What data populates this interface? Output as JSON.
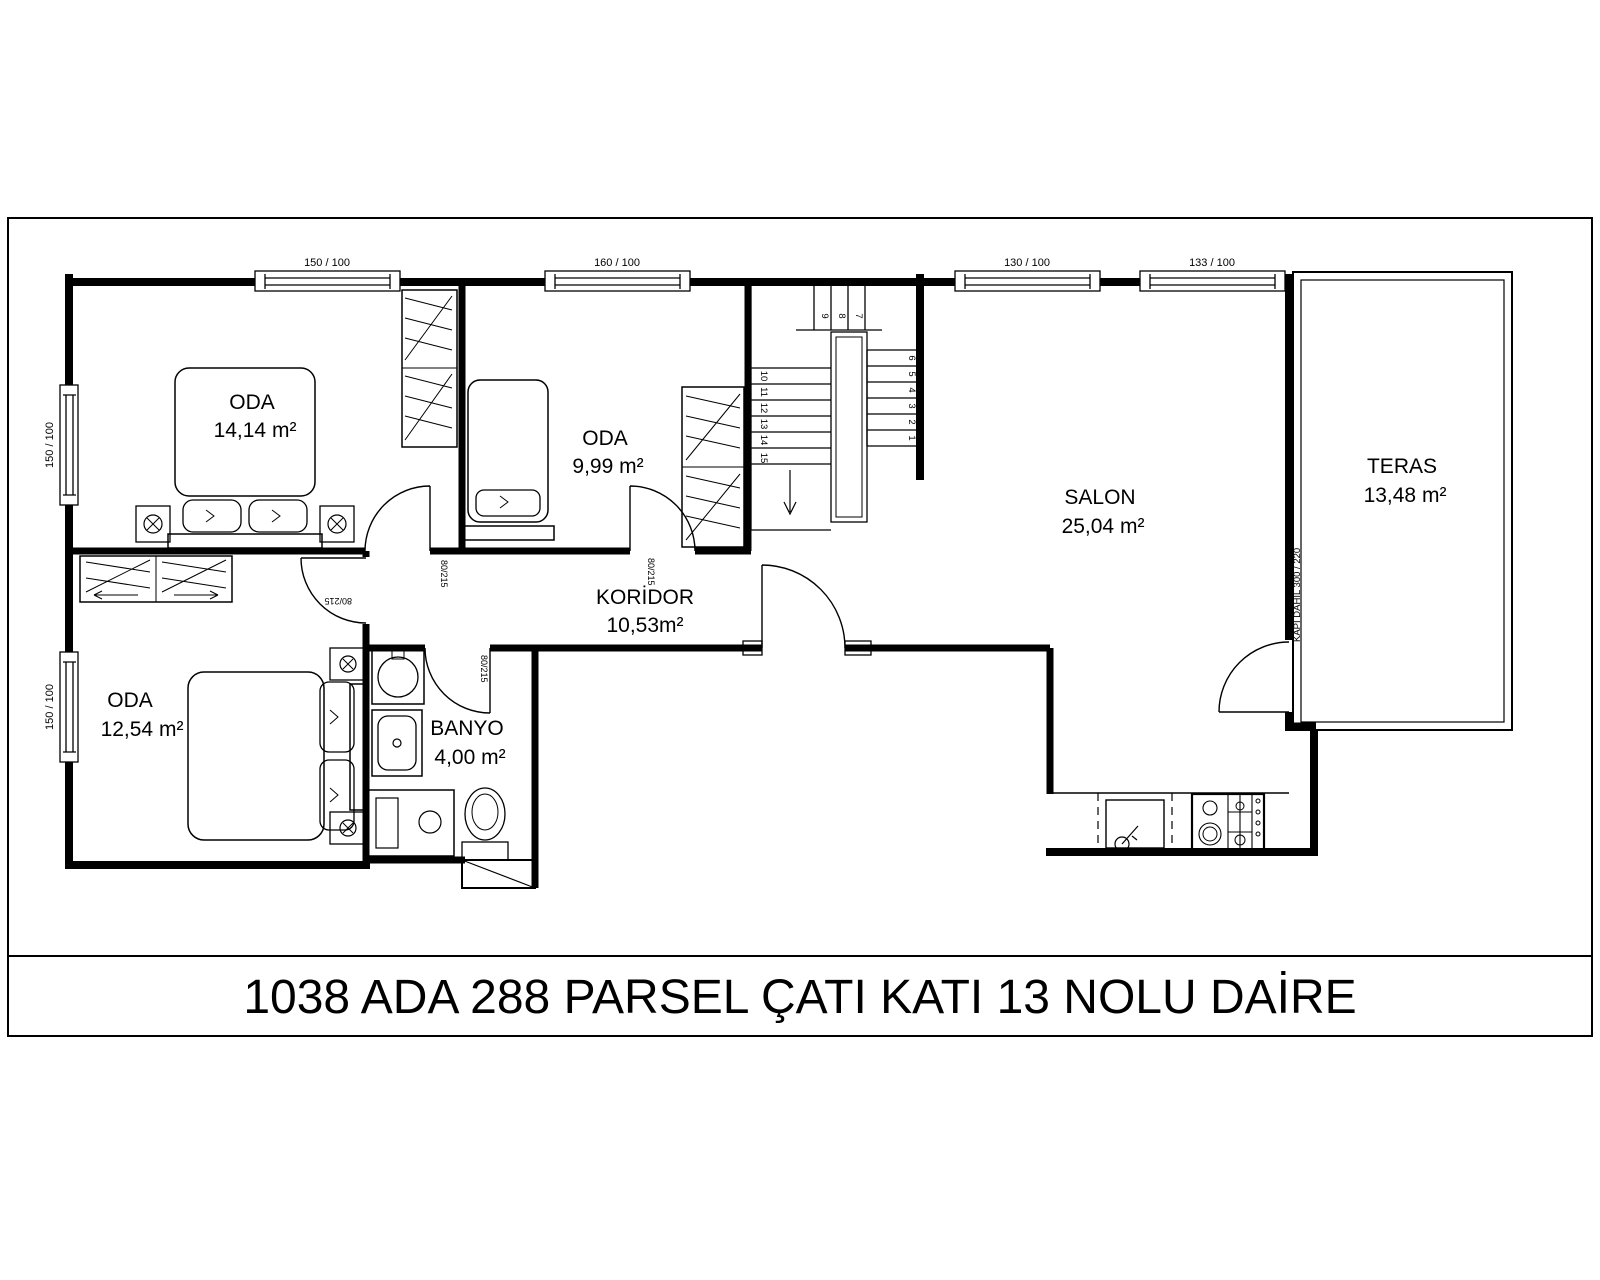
{
  "title": "1038 ADA 288 PARSEL ÇATI KATI 13 NOLU DAİRE",
  "rooms": {
    "oda1": {
      "name": "ODA",
      "area": "14,14 m²"
    },
    "oda2": {
      "name": "ODA",
      "area": "9,99 m²"
    },
    "oda3": {
      "name": "ODA",
      "area": "12,54 m²"
    },
    "koridor": {
      "name": "KORİDOR",
      "area": "10,53m²"
    },
    "banyo": {
      "name": "BANYO",
      "area": "4,00 m²"
    },
    "salon": {
      "name": "SALON",
      "area": "25,04 m²"
    },
    "teras": {
      "name": "TERAS",
      "area": "13,48 m²"
    }
  },
  "windows": {
    "top1": "150 / 100",
    "top2": "160 / 100",
    "top3": "130 / 100",
    "top4": "133 / 100",
    "left1": "150 / 100",
    "left2": "150 / 100"
  },
  "doors": {
    "oda1": "80/215",
    "oda2": "80/215",
    "oda3": "80/215",
    "banyo": "80/215"
  },
  "teras_door_note": "KAPI DAHİL 300 / 220",
  "stairs": {
    "steps": [
      "1",
      "2",
      "3",
      "4",
      "5",
      "6",
      "7",
      "8",
      "9",
      "10",
      "11",
      "12",
      "13",
      "14",
      "15"
    ]
  },
  "colors": {
    "line": "#000000",
    "background": "#ffffff"
  }
}
